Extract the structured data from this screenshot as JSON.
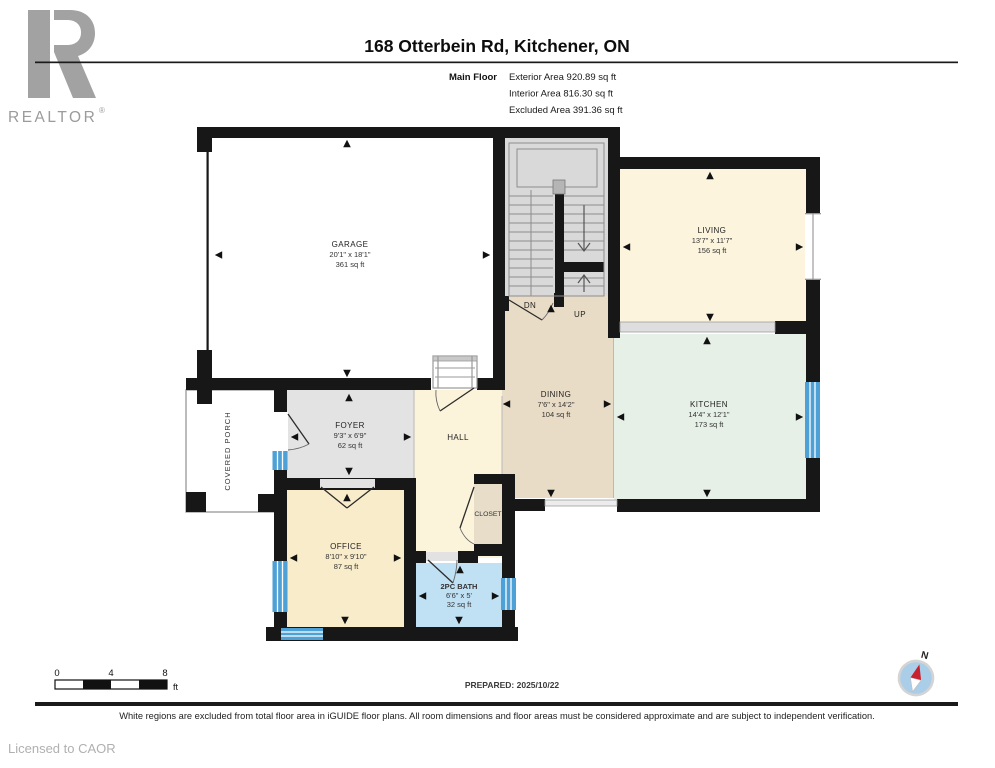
{
  "header": {
    "logo_text": "REALTOR",
    "logo_reg": "®",
    "title": "168 Otterbein Rd, Kitchener, ON",
    "floor_label": "Main Floor",
    "stat_exterior": "Exterior Area 920.89 sq ft",
    "stat_interior": "Interior Area 816.30 sq ft",
    "stat_excluded": "Excluded Area 391.36 sq ft"
  },
  "rooms": {
    "garage": {
      "name": "GARAGE",
      "dims": "20'1\" x 18'1\"",
      "area": "361 sq ft"
    },
    "living": {
      "name": "LIVING",
      "dims": "13'7\" x 11'7\"",
      "area": "156 sq ft"
    },
    "dining": {
      "name": "DINING",
      "dims": "7'6\" x 14'2\"",
      "area": "104 sq ft"
    },
    "kitchen": {
      "name": "KITCHEN",
      "dims": "14'4\" x 12'1\"",
      "area": "173 sq ft"
    },
    "foyer": {
      "name": "FOYER",
      "dims": "9'3\" x 6'9\"",
      "area": "62 sq ft"
    },
    "office": {
      "name": "OFFICE",
      "dims": "8'10\" x 9'10\"",
      "area": "87 sq ft"
    },
    "bath": {
      "name": "2PC BATH",
      "dims": "6'6\" x 5'",
      "area": "32 sq ft"
    },
    "hall": {
      "name": "HALL"
    },
    "closet": {
      "name": "CLOSET"
    },
    "porch": {
      "name": "COVERED PORCH"
    },
    "stairs": {
      "dn": "DN",
      "up": "UP"
    }
  },
  "scale_bar": {
    "tick0": "0",
    "tick4": "4",
    "tick8": "8",
    "unit": "ft"
  },
  "prepared": "PREPARED: 2025/10/22",
  "compass": {
    "north_label": "N"
  },
  "footer": {
    "disclaimer": "White regions are excluded from total floor area in iGUIDE floor plans. All room dimensions and floor areas must be considered approximate and are subject to independent verification.",
    "license": "Licensed to CAOR"
  },
  "colors": {
    "wall": "#171717",
    "living": "#fcf4dc",
    "kitchen": "#e7f0e7",
    "dining": "#e9dcc6",
    "hall": "#fbf3da",
    "office": "#f9ecca",
    "bath": "#c0e0f4",
    "closet": "#e7ddc9",
    "foyer": "#e3e3e3",
    "stairs": "#d9d9d9",
    "window": "#4da1d6",
    "compass_face": "#aacde8",
    "compass_needle": "#c8202f"
  }
}
